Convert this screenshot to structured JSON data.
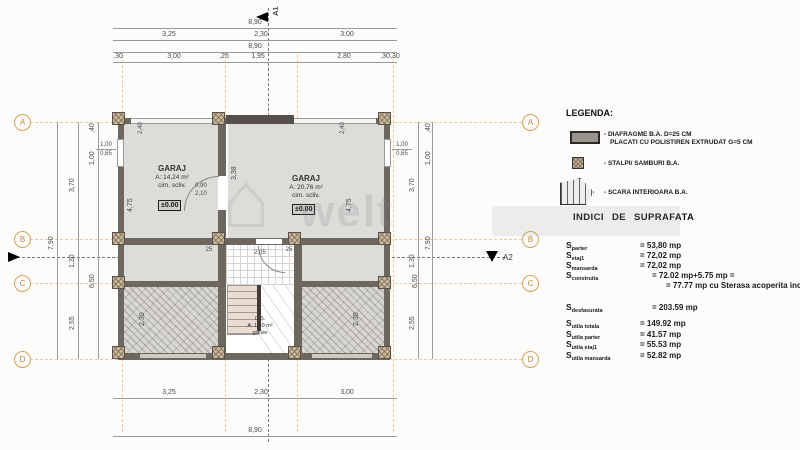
{
  "axes": {
    "letters": [
      "A",
      "B",
      "C",
      "D"
    ]
  },
  "markers": {
    "a1": "A1",
    "a2": "A2"
  },
  "dims": {
    "top": {
      "total": "8,90",
      "segments": [
        "3,25",
        "2,30",
        "3,00"
      ],
      "total2": "8,90",
      "details": [
        ",30",
        "3,00",
        ",25",
        "1,95",
        "2,80",
        ",30,30"
      ]
    },
    "bottom": {
      "segments": [
        "3,25",
        "2,30",
        "3,00"
      ],
      "total": "8,90"
    },
    "left": {
      "total": "7,90",
      "seg_ab": "3,70",
      "seg_bc": "1,30",
      "seg_cd": "2,55",
      "margin": ",40",
      "win": "1,00",
      "span": "6,50"
    },
    "right": {
      "total": "7,90",
      "seg_ab": "3,70",
      "seg_bc": "1,30",
      "seg_cd": "2,55",
      "margin": ",40",
      "win": "1,00",
      "span": "6,50"
    },
    "interior": {
      "garage_left_h": "4,75",
      "garage_right_h": "4,75",
      "mid_wall": "3,38",
      "door_w": "0,90",
      "door_h": "2,10",
      "hall_left": "25",
      "hall_mid": "2,05",
      "hall_right": "25",
      "terrace_left": "2,30",
      "terrace_right": "2,30",
      "gdoor_left": "2,40",
      "gdoor_right": "2,40",
      "win_w": "1,00",
      "win_h": "0,65"
    }
  },
  "rooms": {
    "garage_left": {
      "name": "GARAJ",
      "area": "A: 14,24 m²",
      "finish": "cim. scliv.",
      "level": "±0.00"
    },
    "garage_right": {
      "name": "GARAJ",
      "area": "A: 20,76 m²",
      "finish": "cim. scliv.",
      "level": "±0.00"
    },
    "stair": {
      "name": "C.S.",
      "area": "A: 1,40 m²",
      "finish": "gresie"
    }
  },
  "legend": {
    "title": "LEGENDA:",
    "diafragme_line1": "- DIAFRAGME B.A. D=25 CM",
    "diafragme_line2": "PLACATI CU POLISTIREN EXTRUDAT G=5 CM",
    "stalpi": "- STALPI/ SAMBURI B.A.",
    "scara": "- SCARA INTERIOARA B.A."
  },
  "indici": {
    "title": "INDICI DE SUPRAFATA",
    "rows": [
      {
        "sym": "S",
        "sub": "parter",
        "val": "= 53,80 mp"
      },
      {
        "sym": "S",
        "sub": "etaj1",
        "val": "= 72,02 mp"
      },
      {
        "sym": "S",
        "sub": "mansarda",
        "val": "= 72,02 mp"
      },
      {
        "sym": "S",
        "sub": "construita",
        "val": "= 72.02 mp+5.75 mp ="
      },
      {
        "sym": "",
        "sub": "",
        "val": "= 77.77 mp cu Sterasa acoperita inclusa"
      },
      {
        "sym": "S",
        "sub": "desfasurata",
        "val": "= 203.59 mp"
      },
      {
        "sym": "S",
        "sub": "utila totala",
        "val": "= 149.92 mp"
      },
      {
        "sym": "S",
        "sub": "utila parter",
        "val": "= 41.57 mp"
      },
      {
        "sym": "S",
        "sub": "utila etaj1",
        "val": "= 55.53 mp"
      },
      {
        "sym": "S",
        "sub": "utila mansarda",
        "val": "= 52.82 mp"
      }
    ]
  },
  "watermark": {
    "text": "welt",
    "house_glyph": "⌂"
  },
  "colors": {
    "wall": "#6e6760",
    "room_fill": "#dcdcd9",
    "axis_tan": "#ecc99b",
    "bubble": "#d6a158"
  }
}
